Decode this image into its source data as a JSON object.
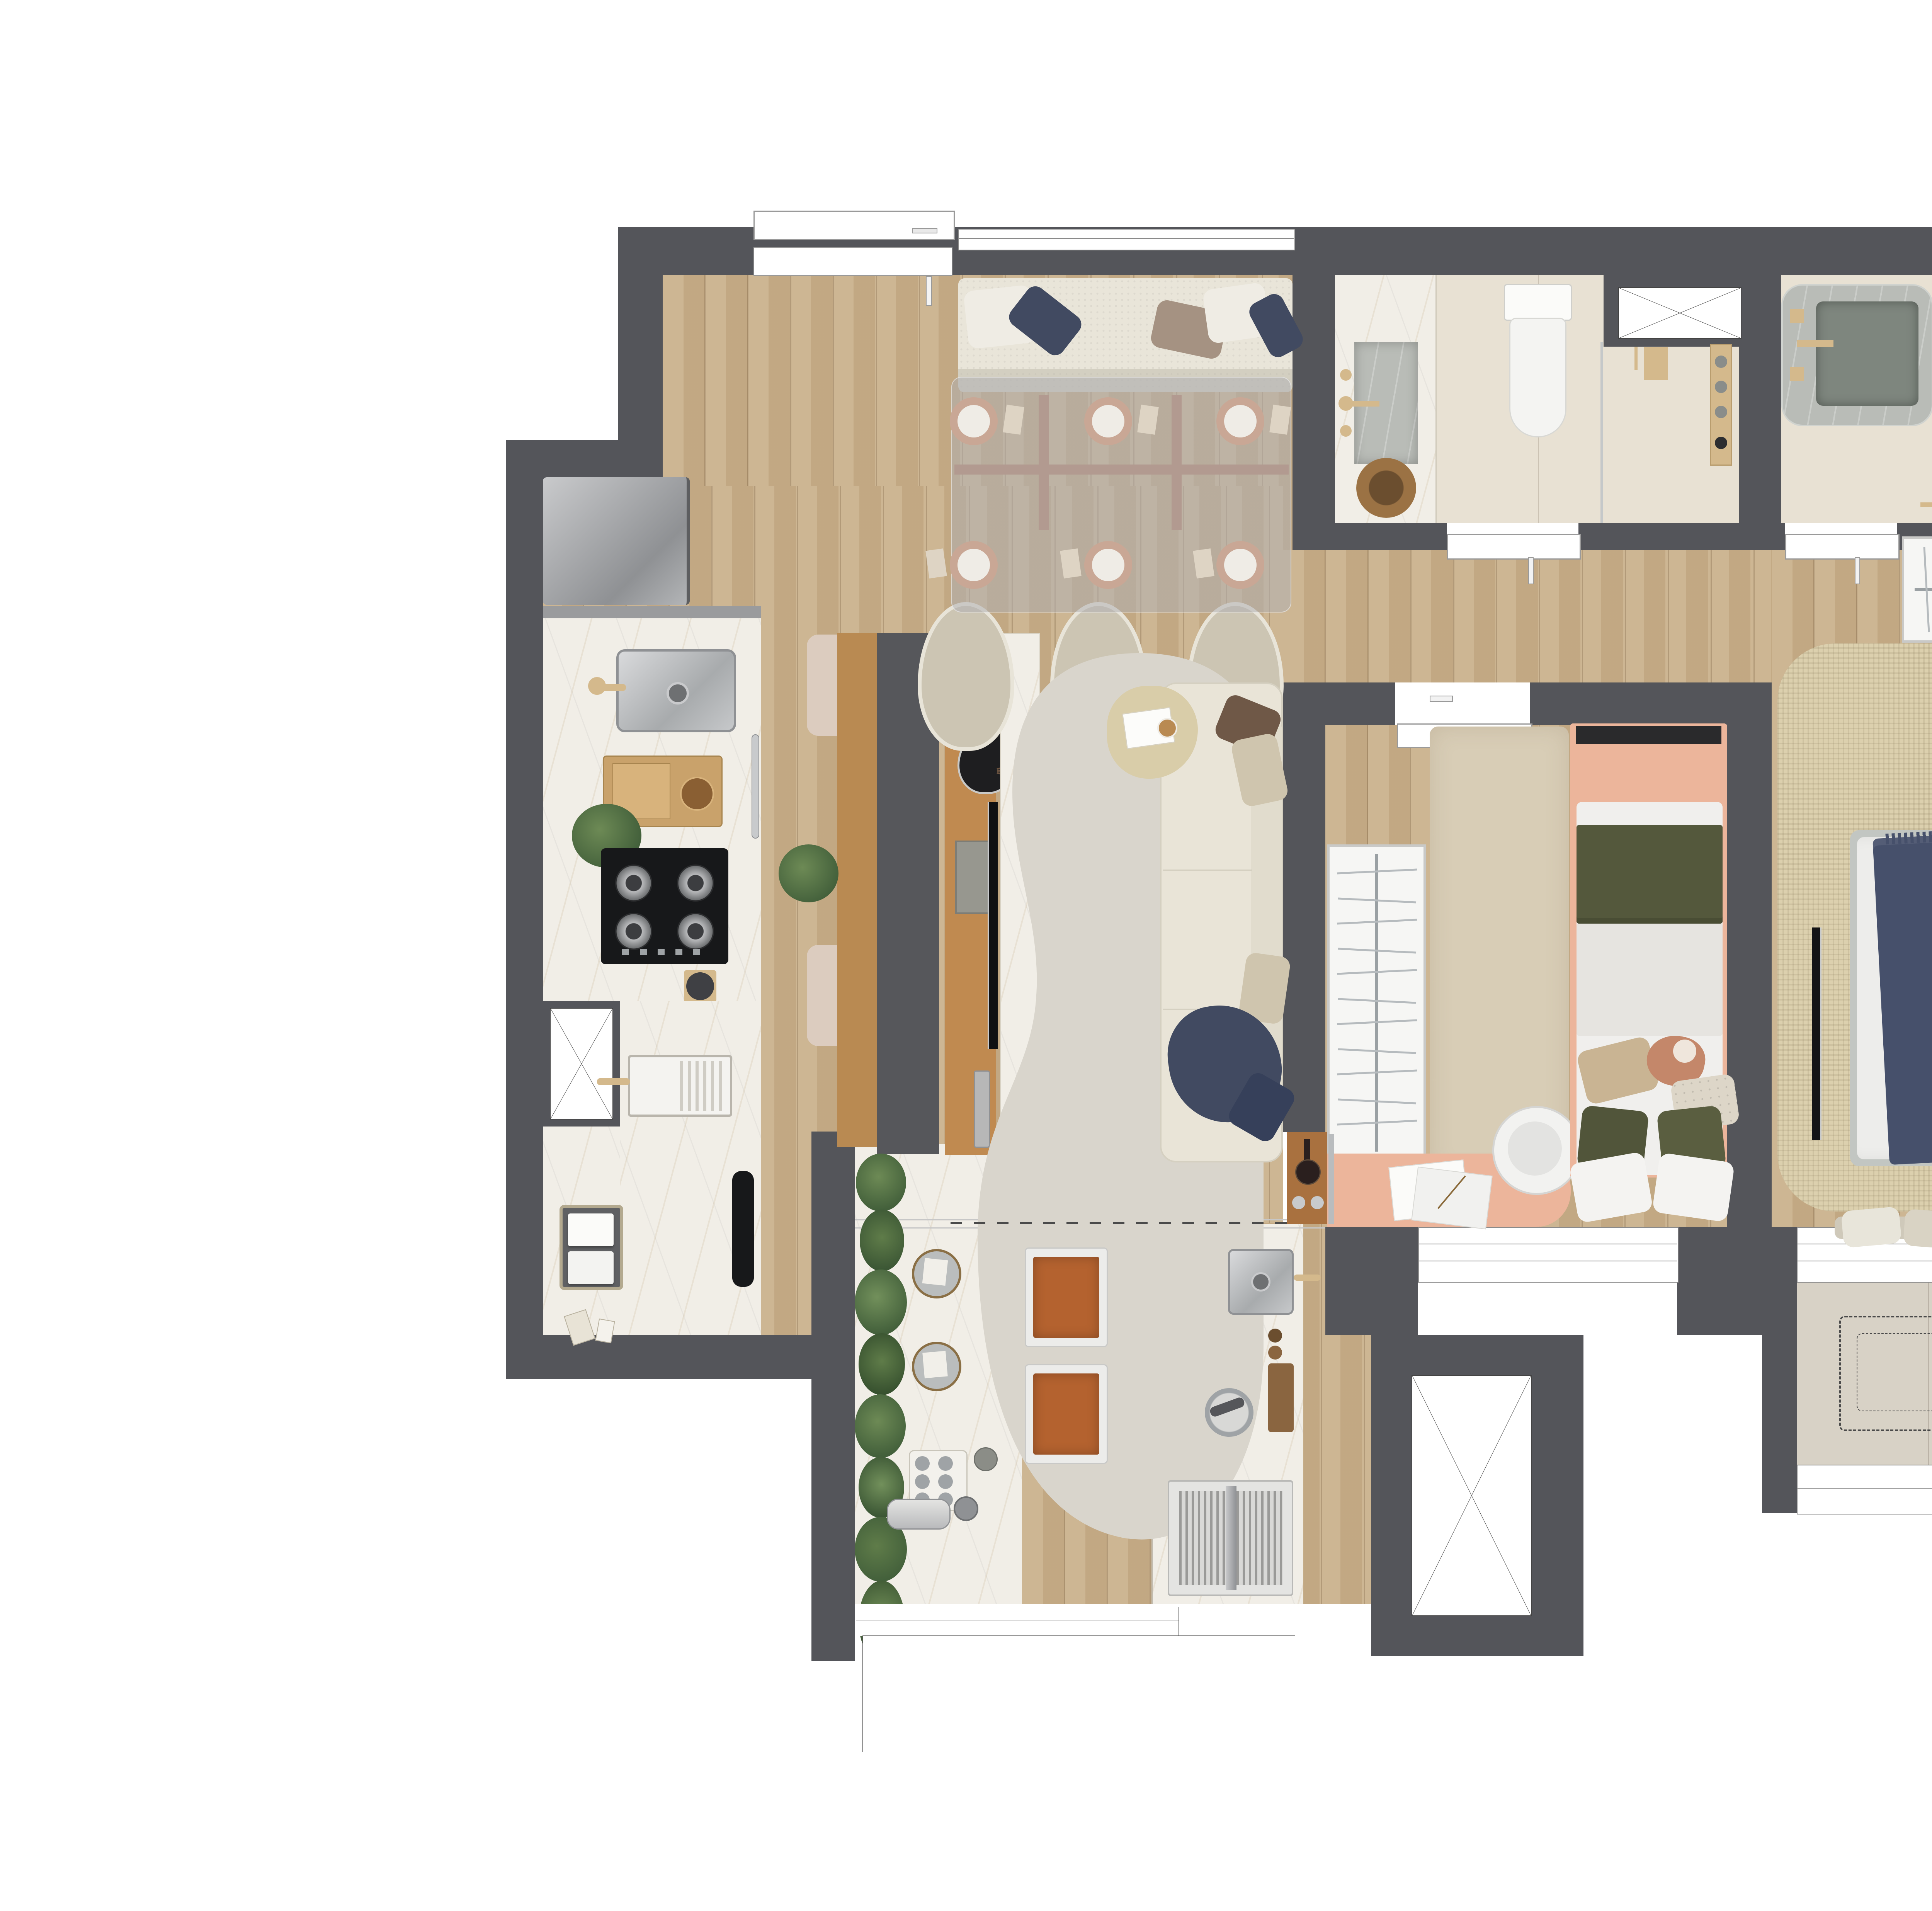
{
  "document": {
    "type": "rendered-floor-plan",
    "title": "apartment-2bed-floor-plan-top-view",
    "visible_text": []
  },
  "palette": {
    "paper": "#ffffff",
    "wall": "#54555a",
    "wood": "#c9b08a",
    "woodDark": "#b98a52",
    "consoleWood": "#c08a50",
    "copper": "#b5826a",
    "copperLight": "#a8755a",
    "marble": "#f1eee7",
    "marbleGray": "#b9bcb7",
    "sinkGray": "#7e867e",
    "bathFloor": "#e8e1d3",
    "stoneBalcony": "#d8d2c6",
    "rugLiving": "#d9d5cc",
    "rugMaster": "#dcd0ae",
    "rugKid": "#d8cdb6",
    "cream": "#e9e5d9",
    "beigeChair": "#ccc5b3",
    "navy": "#414a61",
    "brown": "#6f5847",
    "taupe": "#a59282",
    "peach": "#ecb59b",
    "olive": "#54583c",
    "cognac": "#b4622f",
    "green": "#5f7c49",
    "greenDark": "#43603b",
    "closetWhite": "#f6f6f4",
    "steelDark": "#9fa3a6",
    "black": "#1b1b1d",
    "glass": "rgba(176,177,180,0.52)",
    "duvet": "#ededeb",
    "bedframe": "#c2c6c2",
    "doorWhite": "#ffffff",
    "beigeFixture": "#d4b98c"
  },
  "rooms": [
    {
      "name": "entry-kitchen",
      "furniture": [
        "entry-door",
        "refrigerator",
        "kitchen-sink",
        "snack-tray",
        "gas-cooktop-4-burners",
        "oven-handle",
        "service-shaft",
        "laundry-sink",
        "towel-basket",
        "vacuum-cleaner"
      ]
    },
    {
      "name": "dining-area",
      "furniture": [
        "banquette-bench",
        "glass-dining-table",
        "copper-table-legs",
        "place-settings",
        "upholstered-chairs",
        "window"
      ]
    },
    {
      "name": "living-room",
      "furniture": [
        "island-tv-partition",
        "television",
        "soundbar",
        "speaker",
        "decor-branches",
        "organic-rug",
        "three-seat-sofa",
        "navy-throw",
        "pebble-side-table"
      ]
    },
    {
      "name": "bathroom-1",
      "furniture": [
        "marble-vanity",
        "inset-sink",
        "toilet",
        "glass-shower-partition",
        "shower-fixtures",
        "decor-bowl",
        "shaft"
      ]
    },
    {
      "name": "bathroom-2",
      "furniture": [
        "rounded-stone-vanity",
        "toilet",
        "glass-shower-partition",
        "shower-fixtures",
        "towel-rail",
        "shaft"
      ]
    },
    {
      "name": "bedroom-2",
      "furniture": [
        "open-wardrobe-with-hangers",
        "plush-rug",
        "single-bed",
        "peach-headboard",
        "desk",
        "desk-chair",
        "plush-toy",
        "window"
      ]
    },
    {
      "name": "master-bedroom",
      "furniture": [
        "l-shaped-closet-with-hangers",
        "double-bed",
        "navy-throw",
        "wall-tv",
        "round-nightstands",
        "window-bench-pillows",
        "woven-rug",
        "windows"
      ]
    },
    {
      "name": "master-balcony",
      "furniture": [
        "ac-condenser-dashed-outline",
        "parapet"
      ]
    },
    {
      "name": "gourmet-balcony",
      "furniture": [
        "planter-strip",
        "marble-counter",
        "coffee-machine",
        "cups-tray",
        "place-settings",
        "bar-stools",
        "grill-counter",
        "balcony-sink",
        "stainless-grill",
        "cutting-board",
        "mortar"
      ]
    }
  ],
  "counts": {
    "bedrooms": 2,
    "bathrooms": 2,
    "dining_place_settings": 6,
    "dining_chairs": 3,
    "banquette_pillows": 5,
    "bar_stools": 2,
    "cooktop_burners": 4,
    "shaft_boxes": 4,
    "toilets": 2
  }
}
